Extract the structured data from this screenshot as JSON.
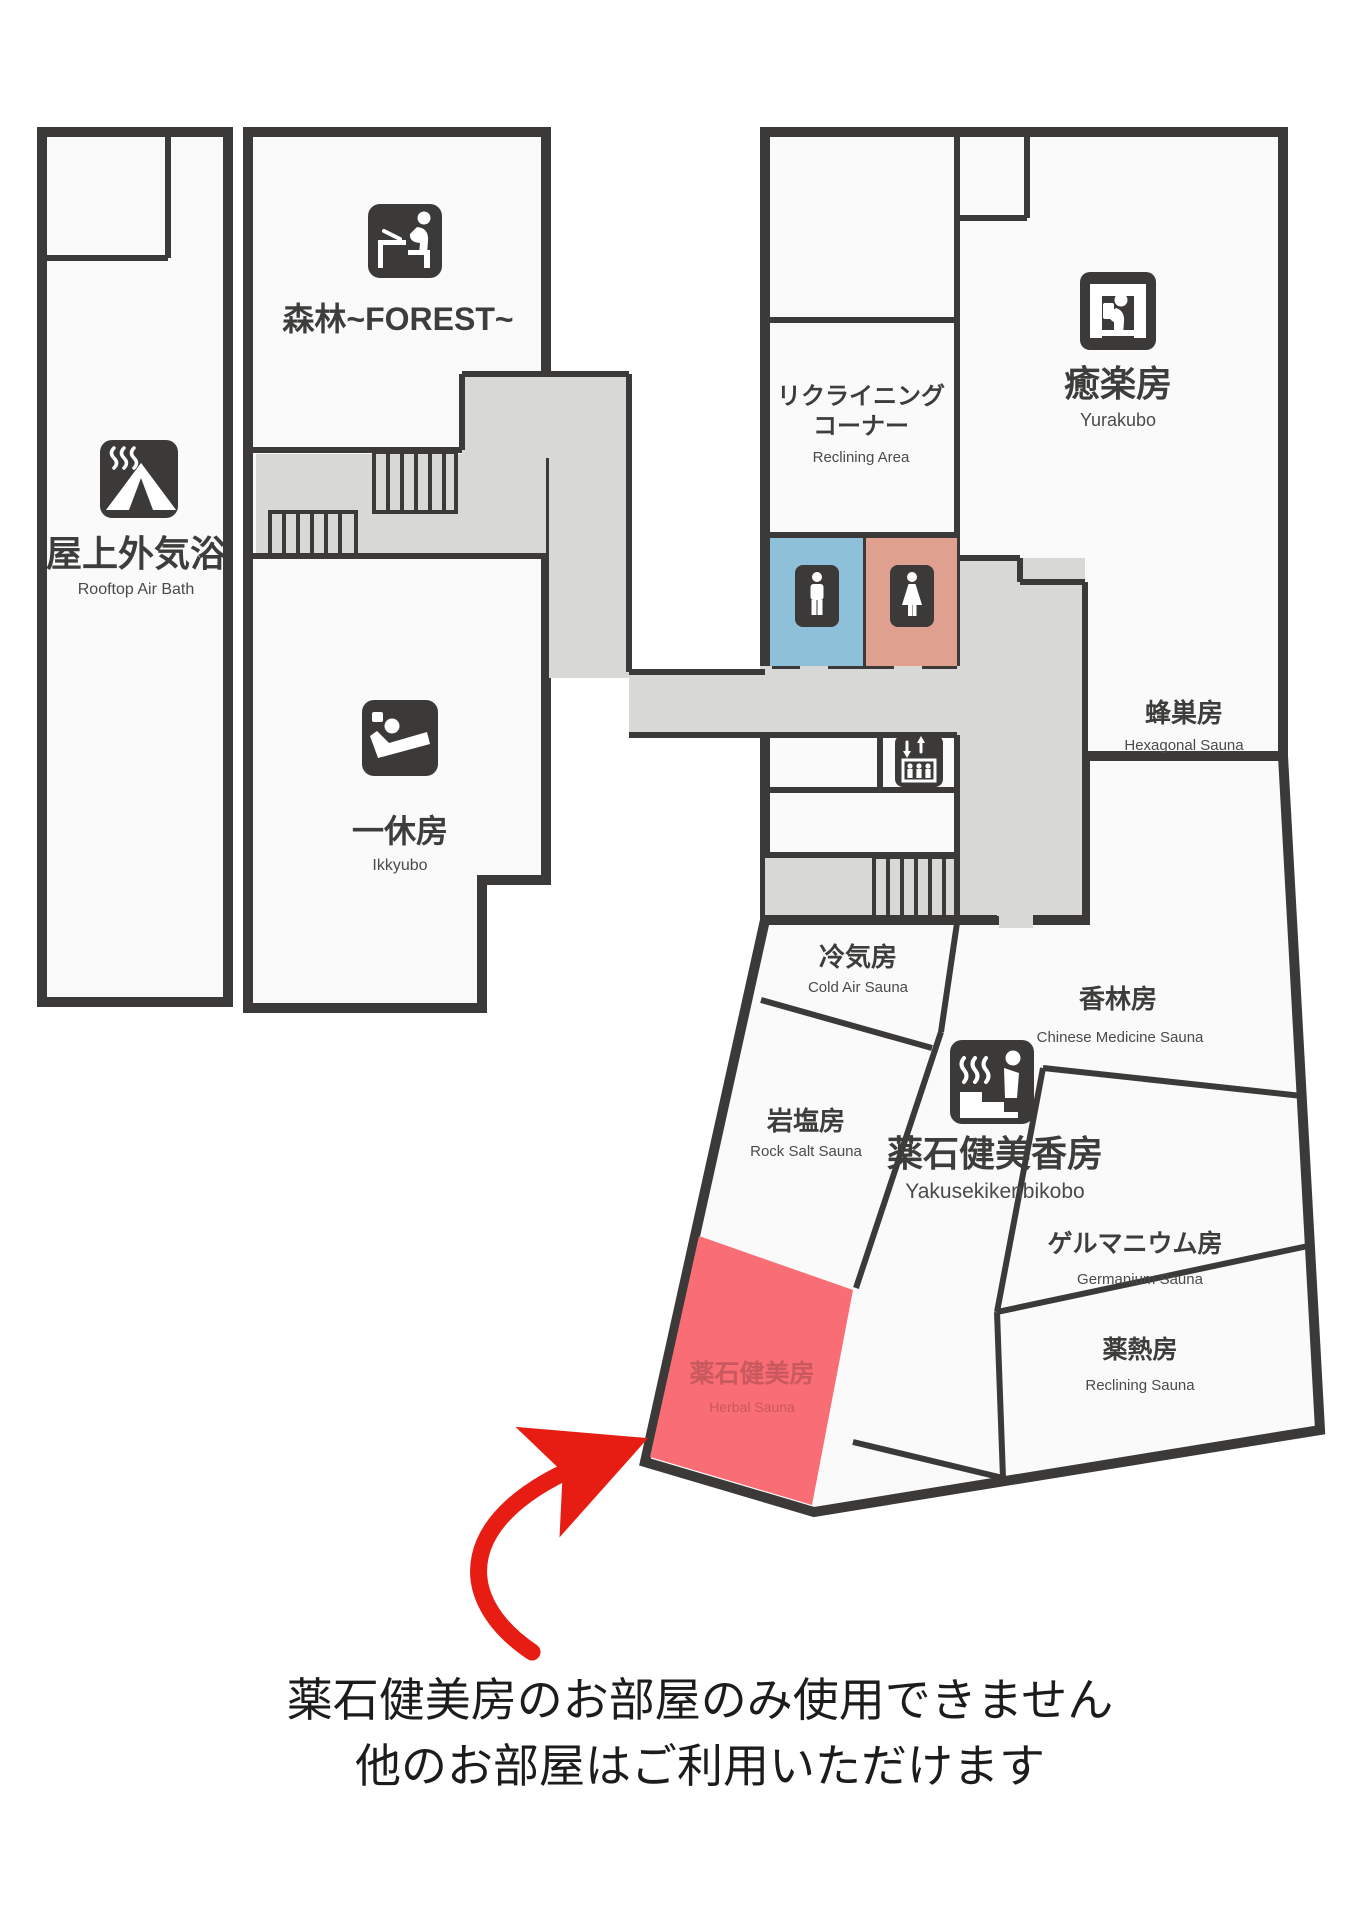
{
  "map_title": "spa-floor-map",
  "colors": {
    "wall": "#3b3a38",
    "room_fill": "#fafafa",
    "corridor": "#d8d8d7",
    "male_room": "#8fc0da",
    "female_room": "#dfa08f",
    "highlight_room": "#f96d74",
    "highlight_text": "#c9595e",
    "arrow": "#e71d13"
  },
  "rooms": {
    "rooftop": {
      "jp": "屋上外気浴",
      "en": "Rooftop Air Bath",
      "icon": "tent-steam-icon"
    },
    "forest": {
      "jp": "森林~FOREST~",
      "icon": "desk-person-icon"
    },
    "ikkyubo": {
      "jp": "一休房",
      "en": "Ikkyubo",
      "icon": "reclining-person-icon"
    },
    "reclining_corner": {
      "jp_line1": "リクライニング",
      "jp_line2": "コーナー",
      "en": "Reclining Area"
    },
    "yurakubo": {
      "jp": "癒楽房",
      "en": "Yurakubo",
      "icon": "reading-person-icon"
    },
    "hexagonal": {
      "jp": "蜂巣房",
      "en": "Hexagonal Sauna"
    },
    "cold_air": {
      "jp": "冷気房",
      "en": "Cold Air Sauna"
    },
    "chinese_medicine": {
      "jp": "香林房",
      "en": "Chinese Medicine Sauna"
    },
    "rock_salt": {
      "jp": "岩塩房",
      "en": "Rock Salt Sauna"
    },
    "yakusekikenbikobo": {
      "jp": "薬石健美香房",
      "en": "Yakusekikenbikobo",
      "icon": "sauna-bench-icon"
    },
    "germanium": {
      "jp": "ゲルマニウム房",
      "en": "Germanium Sauna"
    },
    "yakunetsu": {
      "jp": "薬熱房",
      "en": "Reclining Sauna"
    },
    "herbal": {
      "jp": "薬石健美房",
      "en": "Herbal Sauna"
    }
  },
  "facilities": {
    "male_restroom_icon": "male-icon",
    "female_restroom_icon": "female-icon",
    "elevator_icon": "elevator-icon",
    "stairs": "stairs-hatch"
  },
  "note": {
    "line1": "薬石健美房のお部屋のみ使用できません",
    "line2": "他のお部屋はご利用いただけます"
  }
}
